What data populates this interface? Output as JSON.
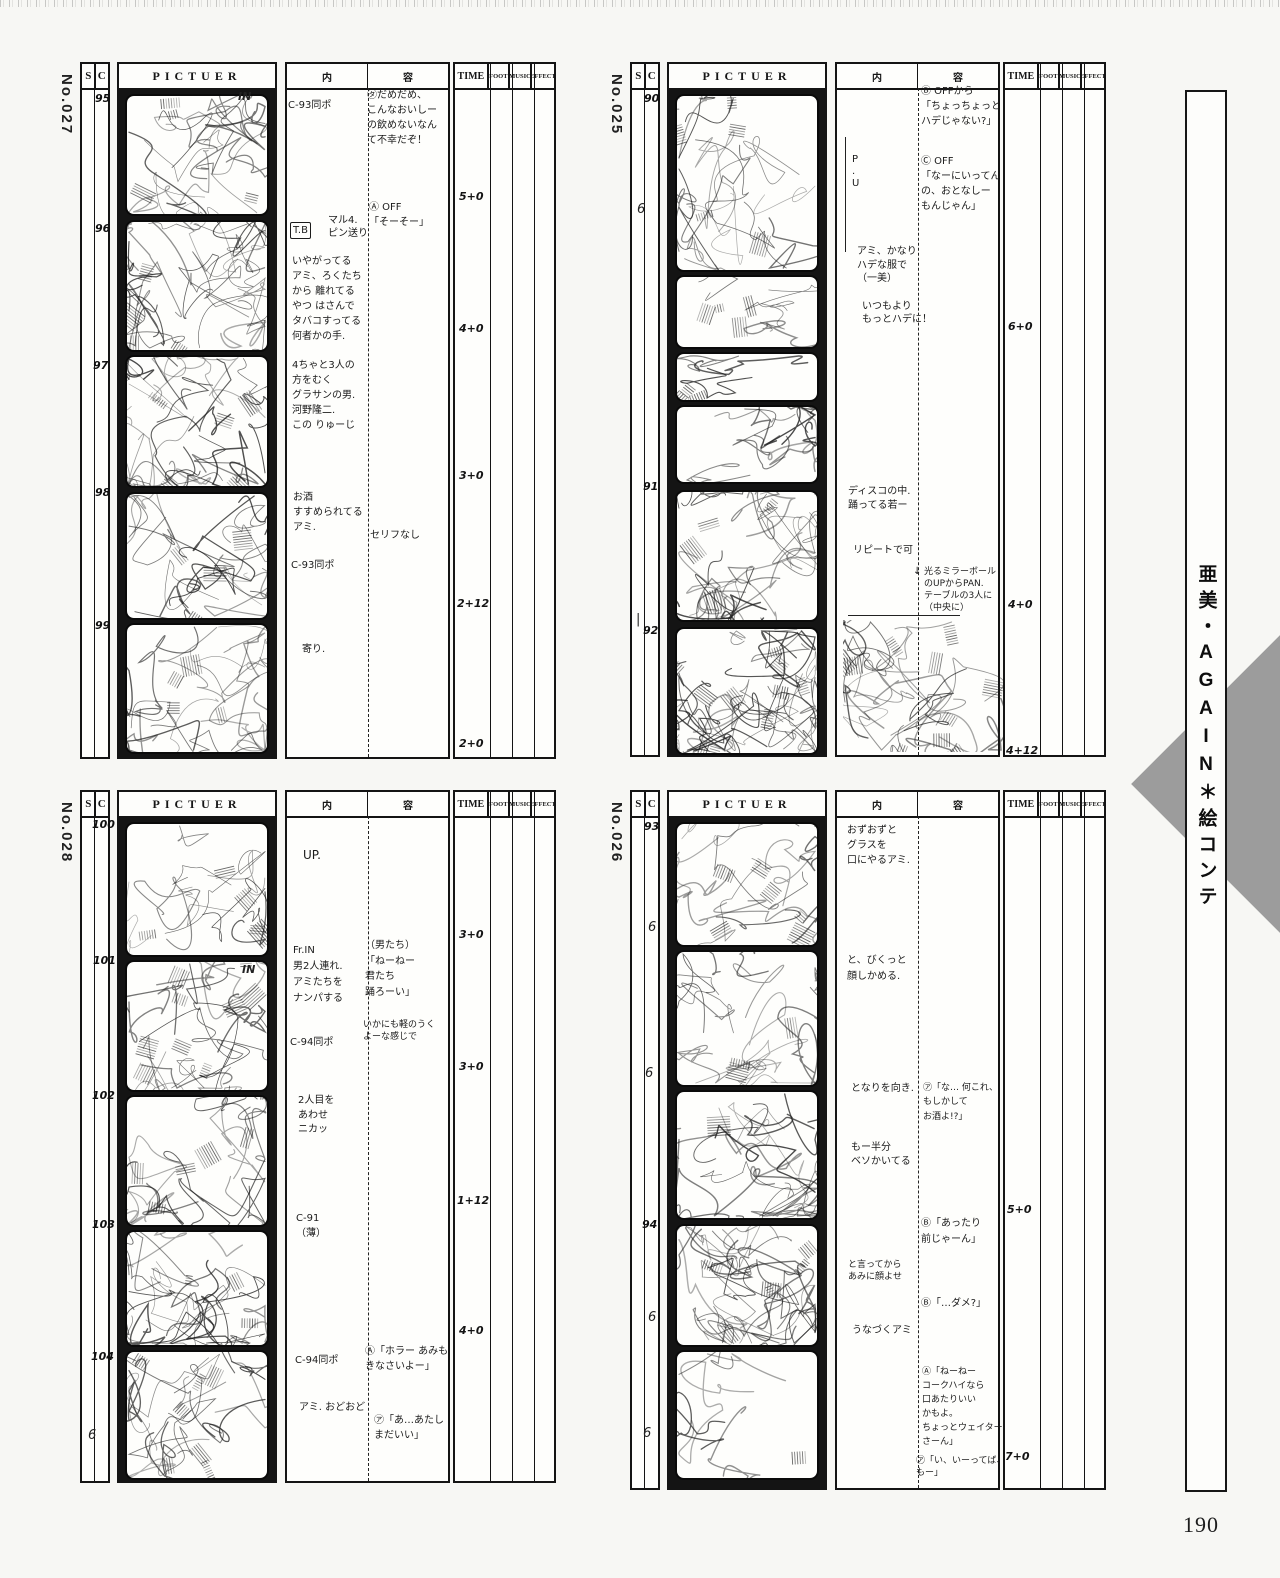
{
  "page": {
    "number": "190",
    "sidebar_title": "亜美・AGAIN＊絵コンテ"
  },
  "columns": {
    "s": "S",
    "c": "C",
    "picture": "PICTUER",
    "content_left": "内",
    "content_right": "容",
    "time": "TIME",
    "foot": "FOOT",
    "music": "MUSIC",
    "effect": "EFFECT"
  },
  "colors": {
    "diamond_gray": "#9c9c9c",
    "ink": "#141414"
  },
  "sheets": [
    {
      "label": "No.027",
      "cut_numbers": [
        "95",
        "96",
        "97",
        "98",
        "99"
      ],
      "times": [
        "5+0",
        "4+0",
        "3+0",
        "2+12",
        "2+0"
      ],
      "frame_marks": [
        "IN"
      ],
      "ticks": [],
      "annotations": [
        "C-93同ポ",
        "㋟だめだめ、\nこんなおいしー\nの飲めないなん\nて不幸だぞ！",
        "Ⓐ OFF\n「そーそー」",
        "T.B",
        "マル4.\nピン送り",
        "いやがってる\nアミ、ろくたち\nから 離れてる\nやつ はさんで\nタバコすってる\n何者かの手.",
        "4ちゃと3人の\n方をむく\nグラサンの男.\n河野隆二.\nこの りゅーじ",
        "お酒\nすすめられてる\nアミ.",
        "セリフなし",
        "C-93同ポ",
        "寄り."
      ]
    },
    {
      "label": "No.025",
      "cut_numbers": [
        "90",
        "91",
        "92"
      ],
      "times": [
        "6+0",
        "4+0",
        "4+12"
      ],
      "frame_marks": [],
      "ticks": [
        "6",
        "|"
      ],
      "annotations": [
        "P\n.\nU",
        "アミ、かなり\nハデな服で\n（一美）",
        "いつもより\nもっとハデに！",
        "Ⓑ OFFから\n「ちょっちょっと\nハデじゃない?」",
        "Ⓒ OFF\n「なーにいってん\nの、おとなしー\nもんじゃん」",
        "ディスコの中.\n踊ってる若ー",
        "リピートで可",
        "光るミラーボール\nのUPからPAN.\nテーブルの3人に\n（中央に）",
        "↓"
      ]
    },
    {
      "label": "No.028",
      "cut_numbers": [
        "100",
        "101",
        "102",
        "103",
        "104"
      ],
      "times": [
        "3+0",
        "3+0",
        "1+12",
        "4+0"
      ],
      "frame_marks": [
        "IN"
      ],
      "ticks": [
        "6"
      ],
      "annotations": [
        "UP.",
        "Fr.IN\n男2人連れ.\nアミたちを\nナンパする",
        "C-94同ポ",
        "（男たち）\n「ねーねー\n君たち\n踊ろーい」",
        "いかにも軽のうく\nよーな感じで",
        "2人目を\nあわせ\nニカッ",
        "C-91\n（薄）",
        "C-94同ポ",
        "アミ. おどおど",
        "Ⓐ「ホラー あみも\nきなさいよー」",
        "㋐「あ…あたし\nまだいい」"
      ]
    },
    {
      "label": "No.026",
      "cut_numbers": [
        "93",
        "94"
      ],
      "times": [
        "5+0",
        "7+0"
      ],
      "frame_marks": [],
      "ticks": [
        "6",
        "6",
        "6",
        "6"
      ],
      "annotations": [
        "おずおずと\nグラスを\n口にやるアミ.",
        "と、びくっと\n顔しかめる.",
        "となりを向き.",
        "もー半分\nベソかいてる",
        "㋐「な… 何これ、\nもしかして\nお酒よ!?」",
        "Ⓑ「あったり\n前じゃーん」",
        "と言ってから\nあみに顔よせ",
        "Ⓑ「…ダメ?」",
        "うなづくアミ",
        "Ⓐ「ねーねー\nコークハイなら\n口あたりいい\nかもよ。\nちょっとウェイター\nさーん」",
        "㋐「い、いーってば、\nもー」"
      ]
    }
  ]
}
